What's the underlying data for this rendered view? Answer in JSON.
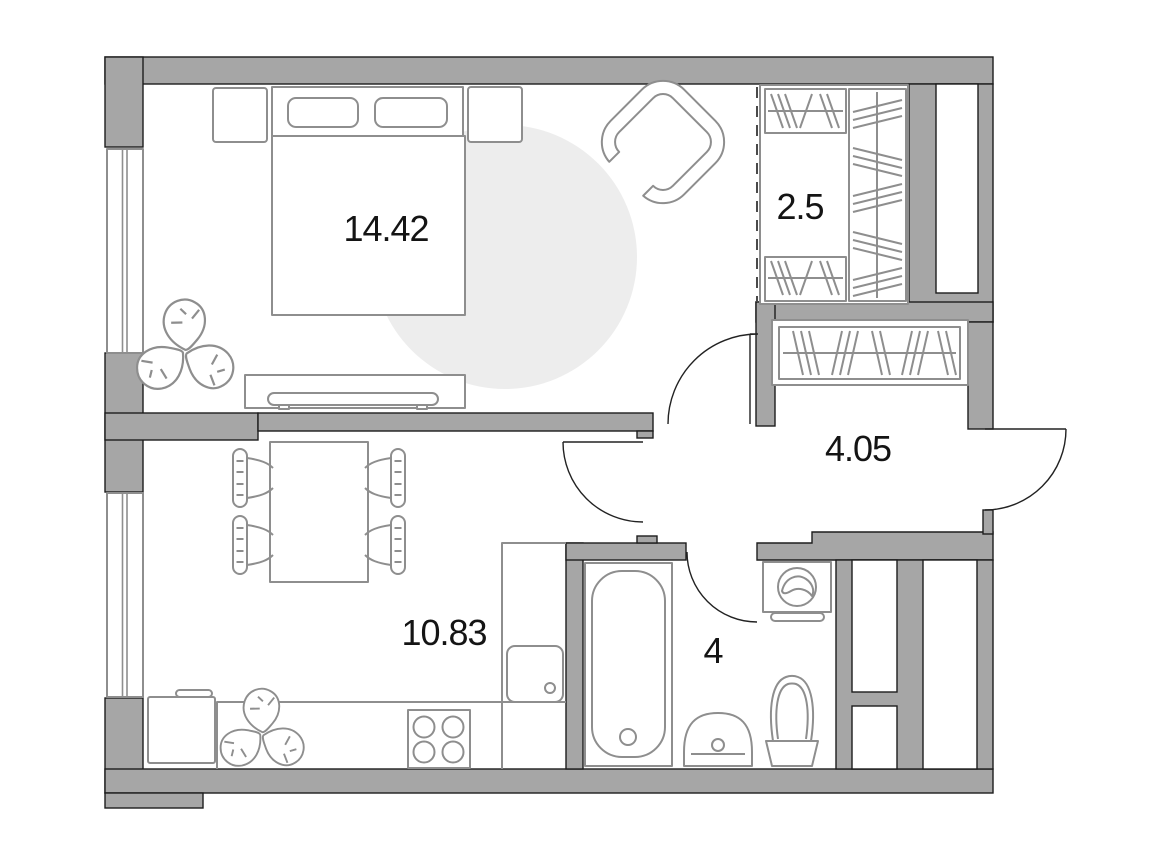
{
  "plan": {
    "type": "apartment-floor-plan",
    "rooms": {
      "bedroom": {
        "icon": "bedroom-zone",
        "area_label": "14.42"
      },
      "wardrobe": {
        "icon": "wardrobe-closet-zone",
        "area_label": "2.5"
      },
      "hallway": {
        "icon": "hallway-zone",
        "area_label": "4.05"
      },
      "kitchen_living": {
        "icon": "kitchen-living-zone",
        "area_label": "10.83"
      },
      "bathroom": {
        "icon": "bathroom-zone",
        "area_label": "4"
      }
    },
    "palette": {
      "wall_fill": "#a6a6a6",
      "wall_outline": "#1d1d1d",
      "furniture_stroke": "#8e8e8e",
      "rug_fill": "#ededed",
      "label_color": "#141414",
      "background": "#ffffff"
    },
    "furniture_icons": [
      "double-bed-icon",
      "pillow-icon",
      "nightstand-icon",
      "armchair-icon",
      "monstera-plant-icon",
      "tv-console-icon",
      "built-in-wardrobe-icon",
      "hallway-wardrobe-icon",
      "dining-table-icon",
      "dining-chair-icon",
      "kitchen-counter-icon",
      "kitchen-sink-icon",
      "stove-icon",
      "fridge-icon",
      "bathtub-icon",
      "washing-machine-icon",
      "bathroom-sink-icon",
      "toilet-icon",
      "window-icon",
      "door-swing-icon",
      "rug-icon"
    ]
  }
}
